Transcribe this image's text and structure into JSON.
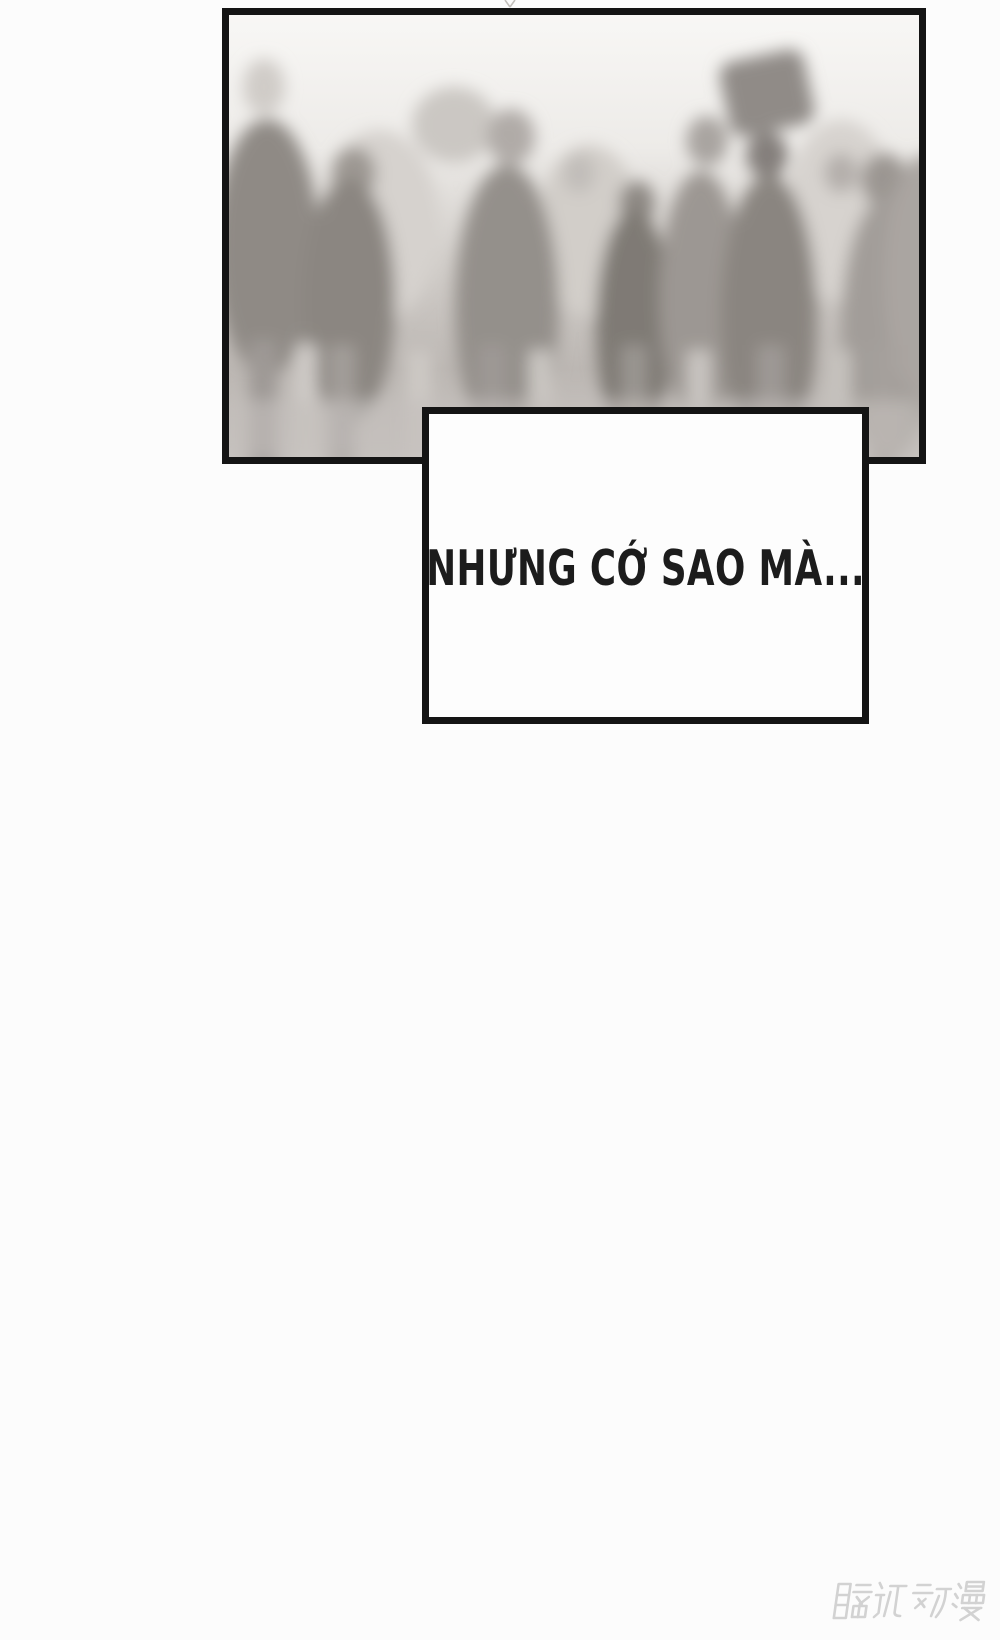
{
  "caption": {
    "text": "NHƯNG CỚ SAO MÀ...",
    "text_color": "#1c1c1c",
    "background": "#fdfdfd",
    "border_color": "#141414"
  },
  "panel": {
    "illustration": "blurred-crowd-silhouettes",
    "border_color": "#141414"
  },
  "watermark": {
    "text": "腾讯动漫",
    "color": "#d2d2d2"
  },
  "colors": {
    "page_background": "#fcfcfc"
  }
}
